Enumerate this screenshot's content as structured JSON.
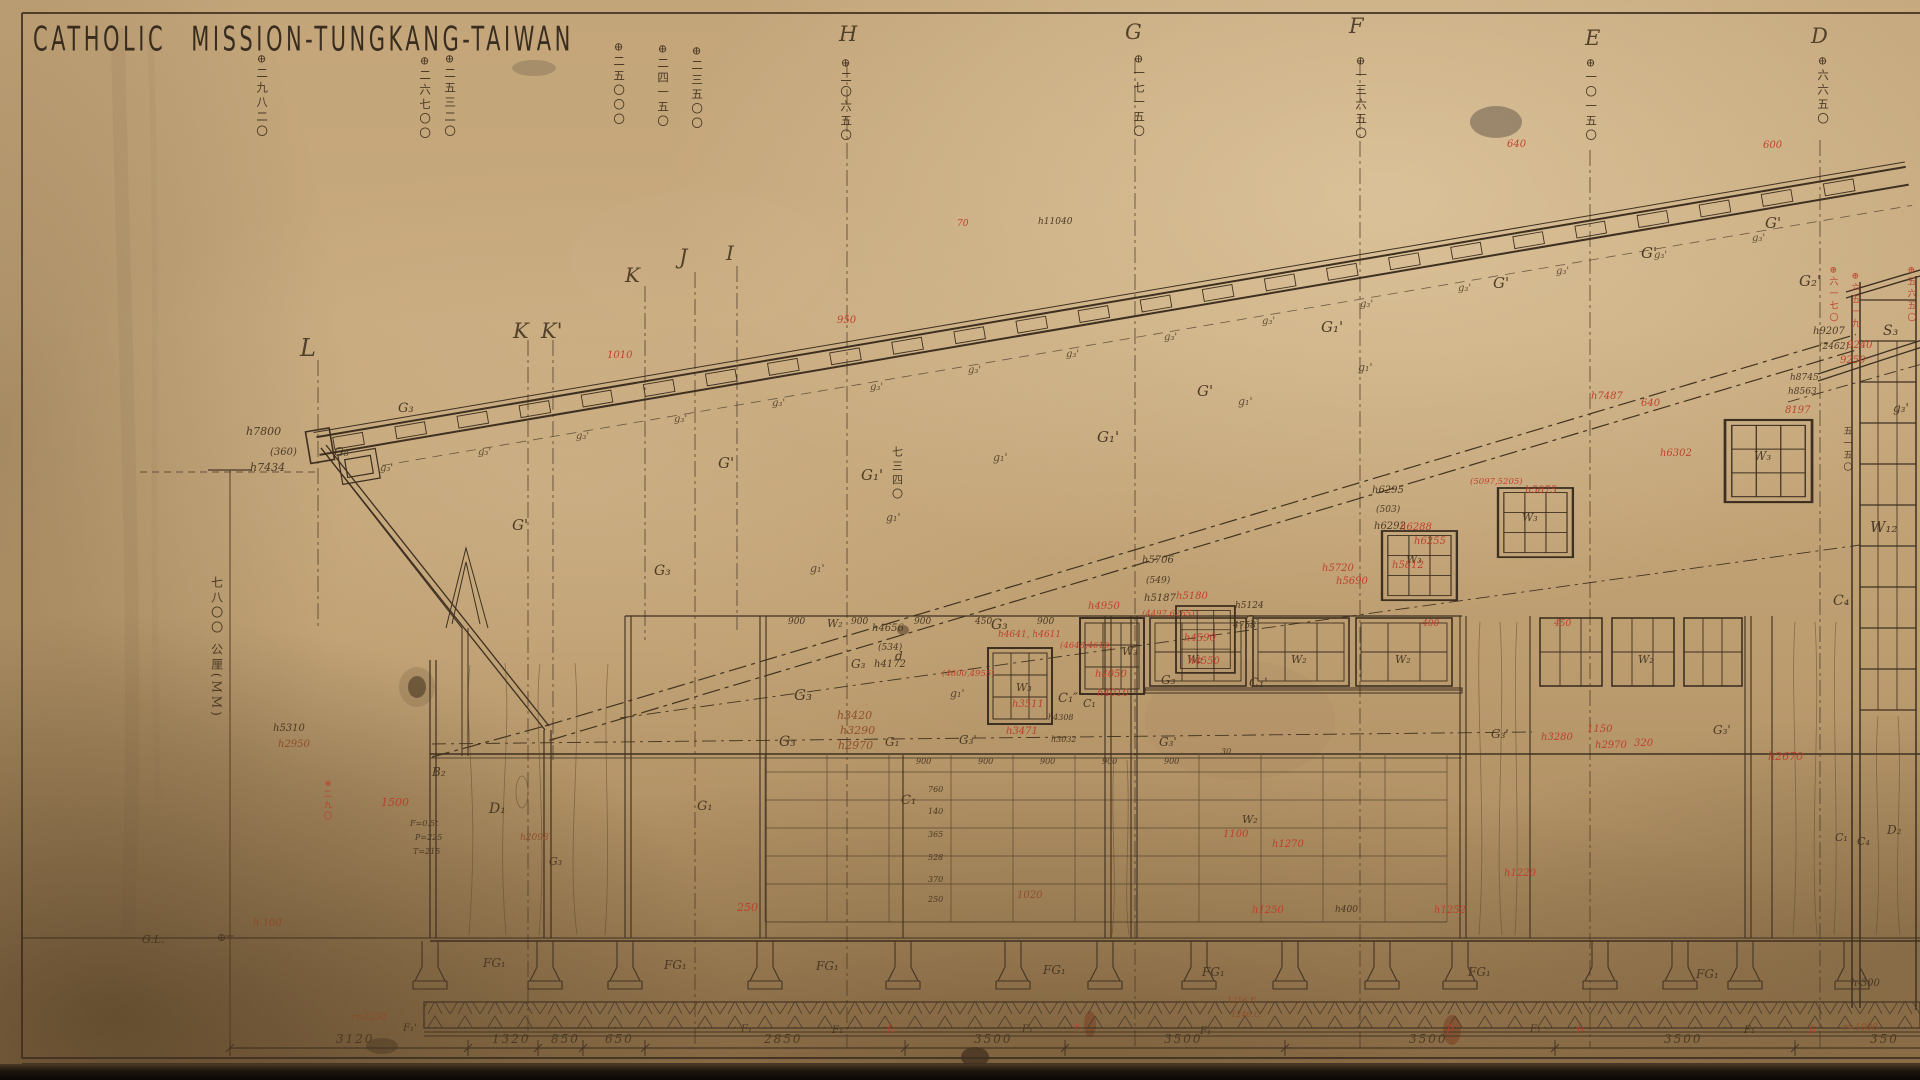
{
  "title": "CATHOLIC MISSION-TUNGKANG-TAIWAN",
  "colors": {
    "k": "#43331f",
    "r": "#bf3a28",
    "b": "#8d4a26"
  },
  "grid_letters": [
    {
      "t": "L",
      "x": 300,
      "y": 336,
      "s": 24
    },
    {
      "t": "K",
      "x": 513,
      "y": 321,
      "s": 21
    },
    {
      "t": "K'",
      "x": 541,
      "y": 321,
      "s": 21
    },
    {
      "t": "K",
      "x": 625,
      "y": 265,
      "s": 20
    },
    {
      "t": "J",
      "x": 679,
      "y": 247,
      "s": 21
    },
    {
      "t": "I",
      "x": 726,
      "y": 243,
      "s": 20
    },
    {
      "t": "H",
      "x": 839,
      "y": 24,
      "s": 21
    },
    {
      "t": "G",
      "x": 1125,
      "y": 22,
      "s": 21
    },
    {
      "t": "F",
      "x": 1349,
      "y": 16,
      "s": 21
    },
    {
      "t": "E",
      "x": 1585,
      "y": 28,
      "s": 21
    },
    {
      "t": "D",
      "x": 1811,
      "y": 26,
      "s": 21
    }
  ],
  "elevation_marks": [
    {
      "t": "⊕二九八二〇",
      "x": 256,
      "y": 54
    },
    {
      "t": "⊕二六七〇〇",
      "x": 419,
      "y": 56
    },
    {
      "t": "⊕二五三二〇",
      "x": 444,
      "y": 54
    },
    {
      "t": "⊕二五〇〇〇",
      "x": 613,
      "y": 42
    },
    {
      "t": "⊕二四一五〇",
      "x": 657,
      "y": 44
    },
    {
      "t": "⊕二三五〇〇",
      "x": 691,
      "y": 46
    },
    {
      "t": "⊕二〇六五〇",
      "x": 840,
      "y": 58
    },
    {
      "t": "⊕一七一五〇",
      "x": 1133,
      "y": 54
    },
    {
      "t": "⊕一三六五〇",
      "x": 1355,
      "y": 56
    },
    {
      "t": "⊕一〇一五〇",
      "x": 1585,
      "y": 58
    },
    {
      "t": "⊕六六五〇",
      "x": 1817,
      "y": 56
    }
  ],
  "left_scale": {
    "t": "七八〇〇 公厘(MM)",
    "x": 210,
    "y": 576,
    "s": 12
  },
  "bottom_dimensions": {
    "y": 1033,
    "values": [
      {
        "t": "3120",
        "x": 336
      },
      {
        "t": "1320",
        "x": 492
      },
      {
        "t": "850",
        "x": 551
      },
      {
        "t": "650",
        "x": 605
      },
      {
        "t": "2850",
        "x": 764
      },
      {
        "t": "3500",
        "x": 974
      },
      {
        "t": "3500",
        "x": 1164
      },
      {
        "t": "3500",
        "x": 1409
      },
      {
        "t": "3500",
        "x": 1664
      },
      {
        "t": "350",
        "x": 1870
      }
    ]
  },
  "g_marks": {
    "under_text": "g₃'",
    "mid_text": "g₁'",
    "under": [
      [
        380,
        464
      ],
      [
        478,
        448
      ],
      [
        576,
        432
      ],
      [
        674,
        415
      ],
      [
        772,
        399
      ],
      [
        870,
        383
      ],
      [
        968,
        366
      ],
      [
        1066,
        350
      ],
      [
        1164,
        333
      ],
      [
        1262,
        317
      ],
      [
        1360,
        300
      ],
      [
        1458,
        284
      ],
      [
        1556,
        267
      ],
      [
        1654,
        251
      ],
      [
        1752,
        234
      ]
    ],
    "mid": [
      [
        810,
        563
      ],
      [
        886,
        512
      ],
      [
        993,
        452
      ],
      [
        1238,
        396
      ],
      [
        1358,
        362
      ],
      [
        950,
        688
      ]
    ]
  },
  "annotations": [
    {
      "t": "h7800",
      "x": 246,
      "y": 426,
      "s": 11
    },
    {
      "t": "(360)",
      "x": 270,
      "y": 448,
      "s": 10
    },
    {
      "t": "h7434",
      "x": 250,
      "y": 462,
      "s": 11
    },
    {
      "t": "G₈",
      "x": 334,
      "y": 446,
      "s": 12
    },
    {
      "t": "G₃",
      "x": 398,
      "y": 402,
      "s": 13
    },
    {
      "t": "h11040",
      "x": 1038,
      "y": 218,
      "s": 9
    },
    {
      "t": "G'",
      "x": 512,
      "y": 518,
      "s": 15
    },
    {
      "t": "G'",
      "x": 718,
      "y": 456,
      "s": 15
    },
    {
      "t": "G₁'",
      "x": 861,
      "y": 468,
      "s": 15
    },
    {
      "t": "G₁'",
      "x": 1097,
      "y": 430,
      "s": 15
    },
    {
      "t": "G'",
      "x": 1197,
      "y": 384,
      "s": 15
    },
    {
      "t": "G₁'",
      "x": 1321,
      "y": 320,
      "s": 15
    },
    {
      "t": "G'",
      "x": 1493,
      "y": 276,
      "s": 15
    },
    {
      "t": "G'",
      "x": 1641,
      "y": 246,
      "s": 15
    },
    {
      "t": "G'",
      "x": 1765,
      "y": 216,
      "s": 15
    },
    {
      "t": "G₂'",
      "x": 1799,
      "y": 274,
      "s": 15
    },
    {
      "t": "S₃",
      "x": 1883,
      "y": 324,
      "s": 14
    },
    {
      "t": "g₃'",
      "x": 1893,
      "y": 402,
      "s": 12
    },
    {
      "t": "G₃",
      "x": 654,
      "y": 564,
      "s": 14
    },
    {
      "t": "G₃",
      "x": 851,
      "y": 658,
      "s": 12
    },
    {
      "t": "G₃",
      "x": 794,
      "y": 688,
      "s": 15
    },
    {
      "t": "G₃",
      "x": 779,
      "y": 735,
      "s": 14
    },
    {
      "t": "G₃",
      "x": 991,
      "y": 618,
      "s": 14
    },
    {
      "t": "G₃",
      "x": 1245,
      "y": 614,
      "s": 12
    },
    {
      "t": "G₃",
      "x": 1161,
      "y": 674,
      "s": 12
    },
    {
      "t": "G₃",
      "x": 549,
      "y": 856,
      "s": 11
    },
    {
      "t": "G₃'",
      "x": 959,
      "y": 734,
      "s": 12
    },
    {
      "t": "G₃'",
      "x": 1159,
      "y": 736,
      "s": 12
    },
    {
      "t": "G₃'",
      "x": 1491,
      "y": 728,
      "s": 12
    },
    {
      "t": "G₃'",
      "x": 1713,
      "y": 724,
      "s": 12
    },
    {
      "t": "G₁",
      "x": 885,
      "y": 736,
      "s": 12
    },
    {
      "t": "G₁",
      "x": 697,
      "y": 800,
      "s": 13
    },
    {
      "t": "C₁",
      "x": 901,
      "y": 794,
      "s": 13
    },
    {
      "t": "C₁″",
      "x": 1058,
      "y": 692,
      "s": 13
    },
    {
      "t": "C₁",
      "x": 1083,
      "y": 698,
      "s": 11
    },
    {
      "t": "C₁'",
      "x": 1249,
      "y": 677,
      "s": 13
    },
    {
      "t": "C₄",
      "x": 1833,
      "y": 594,
      "s": 14
    },
    {
      "t": "C₁",
      "x": 1835,
      "y": 832,
      "s": 11
    },
    {
      "t": "C₄",
      "x": 1857,
      "y": 836,
      "s": 11
    },
    {
      "t": "D₂",
      "x": 1887,
      "y": 824,
      "s": 12
    },
    {
      "t": "D₁",
      "x": 489,
      "y": 802,
      "s": 14
    },
    {
      "t": "B₂",
      "x": 432,
      "y": 766,
      "s": 12
    },
    {
      "t": "d",
      "x": 895,
      "y": 650,
      "s": 12
    },
    {
      "t": "W₂",
      "x": 827,
      "y": 618,
      "s": 11
    },
    {
      "t": "W₂",
      "x": 1187,
      "y": 654,
      "s": 11
    },
    {
      "t": "W₂",
      "x": 1291,
      "y": 654,
      "s": 11
    },
    {
      "t": "W₂",
      "x": 1395,
      "y": 654,
      "s": 11
    },
    {
      "t": "W₂",
      "x": 1638,
      "y": 654,
      "s": 11
    },
    {
      "t": "W₂",
      "x": 1242,
      "y": 814,
      "s": 11
    },
    {
      "t": "W₃",
      "x": 1016,
      "y": 682,
      "s": 11
    },
    {
      "t": "W₃",
      "x": 1122,
      "y": 646,
      "s": 11
    },
    {
      "t": "W₃",
      "x": 1406,
      "y": 554,
      "s": 11
    },
    {
      "t": "W₃",
      "x": 1522,
      "y": 512,
      "s": 11
    },
    {
      "t": "W₃",
      "x": 1754,
      "y": 450,
      "s": 12
    },
    {
      "t": "W₁₂",
      "x": 1870,
      "y": 520,
      "s": 15
    },
    {
      "t": "h4656",
      "x": 872,
      "y": 624,
      "s": 10
    },
    {
      "t": "(534)",
      "x": 878,
      "y": 644,
      "s": 9
    },
    {
      "t": "h4172",
      "x": 874,
      "y": 660,
      "s": 10
    },
    {
      "t": "h5706",
      "x": 1142,
      "y": 556,
      "s": 10
    },
    {
      "t": "(549)",
      "x": 1146,
      "y": 577,
      "s": 9
    },
    {
      "t": "h5187",
      "x": 1144,
      "y": 594,
      "s": 10
    },
    {
      "t": "h6295",
      "x": 1372,
      "y": 486,
      "s": 10
    },
    {
      "t": "(503)",
      "x": 1376,
      "y": 506,
      "s": 9
    },
    {
      "t": "h6292",
      "x": 1374,
      "y": 522,
      "s": 10
    },
    {
      "t": "h9207",
      "x": 1813,
      "y": 327,
      "s": 10
    },
    {
      "t": "(2462)",
      "x": 1819,
      "y": 343,
      "s": 9
    },
    {
      "t": "h8745",
      "x": 1790,
      "y": 374,
      "s": 9
    },
    {
      "t": "h8563",
      "x": 1788,
      "y": 388,
      "s": 9
    },
    {
      "t": "h5124",
      "x": 1235,
      "y": 602,
      "s": 9
    },
    {
      "t": "4758",
      "x": 1233,
      "y": 622,
      "s": 9
    },
    {
      "t": "h4308",
      "x": 1048,
      "y": 714,
      "s": 8
    },
    {
      "t": "h3032",
      "x": 1051,
      "y": 736,
      "s": 8
    },
    {
      "t": "h5310",
      "x": 273,
      "y": 724,
      "s": 10
    },
    {
      "t": "F=0.5t",
      "x": 410,
      "y": 820,
      "s": 8
    },
    {
      "t": "P=225",
      "x": 415,
      "y": 834,
      "s": 8
    },
    {
      "t": "T=215",
      "x": 413,
      "y": 848,
      "s": 8
    },
    {
      "t": "G.L.",
      "x": 142,
      "y": 934,
      "s": 11
    },
    {
      "t": "⊕",
      "x": 217,
      "y": 932,
      "s": 11
    },
    {
      "t": "h400",
      "x": 1335,
      "y": 906,
      "s": 9
    },
    {
      "t": "h-300",
      "x": 1851,
      "y": 979,
      "s": 10
    },
    {
      "t": "FG₁",
      "x": 483,
      "y": 957,
      "s": 12
    },
    {
      "t": "FG₁",
      "x": 664,
      "y": 959,
      "s": 12
    },
    {
      "t": "FG₁",
      "x": 816,
      "y": 960,
      "s": 12
    },
    {
      "t": "FG₁",
      "x": 1043,
      "y": 964,
      "s": 12
    },
    {
      "t": "FG₁",
      "x": 1202,
      "y": 966,
      "s": 12
    },
    {
      "t": "FG₁",
      "x": 1468,
      "y": 966,
      "s": 12
    },
    {
      "t": "FG₁",
      "x": 1696,
      "y": 968,
      "s": 12
    },
    {
      "t": "F₁'",
      "x": 403,
      "y": 1024,
      "s": 10
    },
    {
      "t": "F₁",
      "x": 741,
      "y": 1025,
      "s": 10
    },
    {
      "t": "F₁",
      "x": 832,
      "y": 1026,
      "s": 10
    },
    {
      "t": "F₁",
      "x": 1022,
      "y": 1025,
      "s": 10
    },
    {
      "t": "F₁",
      "x": 1200,
      "y": 1027,
      "s": 10
    },
    {
      "t": "F₁",
      "x": 1530,
      "y": 1025,
      "s": 10
    },
    {
      "t": "F₁",
      "x": 1744,
      "y": 1026,
      "s": 10
    },
    {
      "t": "30",
      "x": 1221,
      "y": 748,
      "s": 8
    },
    {
      "t": "900",
      "x": 788,
      "y": 618,
      "s": 9
    },
    {
      "t": "900",
      "x": 851,
      "y": 618,
      "s": 9
    },
    {
      "t": "900",
      "x": 914,
      "y": 618,
      "s": 9
    },
    {
      "t": "450",
      "x": 975,
      "y": 618,
      "s": 9
    },
    {
      "t": "900",
      "x": 1037,
      "y": 618,
      "s": 9
    },
    {
      "t": "900",
      "x": 916,
      "y": 758,
      "s": 8
    },
    {
      "t": "900",
      "x": 978,
      "y": 758,
      "s": 8
    },
    {
      "t": "900",
      "x": 1040,
      "y": 758,
      "s": 8
    },
    {
      "t": "900",
      "x": 1102,
      "y": 758,
      "s": 8
    },
    {
      "t": "900",
      "x": 1164,
      "y": 758,
      "s": 8
    },
    {
      "t": "760",
      "x": 928,
      "y": 786,
      "s": 8
    },
    {
      "t": "140",
      "x": 928,
      "y": 808,
      "s": 8
    },
    {
      "t": "365",
      "x": 928,
      "y": 831,
      "s": 8
    },
    {
      "t": "528",
      "x": 928,
      "y": 854,
      "s": 8
    },
    {
      "t": "370",
      "x": 928,
      "y": 876,
      "s": 8
    },
    {
      "t": "250",
      "x": 928,
      "y": 896,
      "s": 8
    },
    {
      "t": "七三四〇",
      "x": 891,
      "y": 446,
      "s": 11,
      "v": 1
    },
    {
      "t": "五一五〇",
      "x": 1841,
      "y": 426,
      "s": 9,
      "v": 1
    },
    {
      "t": "600",
      "x": 1763,
      "y": 141,
      "c": "r",
      "s": 10
    },
    {
      "t": "640",
      "x": 1507,
      "y": 140,
      "c": "r",
      "s": 10
    },
    {
      "t": "70",
      "x": 957,
      "y": 220,
      "c": "r",
      "s": 9
    },
    {
      "t": "950",
      "x": 837,
      "y": 316,
      "c": "r",
      "s": 10
    },
    {
      "t": "1010",
      "x": 607,
      "y": 351,
      "c": "r",
      "s": 10
    },
    {
      "t": "9240",
      "x": 1847,
      "y": 341,
      "c": "r",
      "s": 10
    },
    {
      "t": "9250",
      "x": 1840,
      "y": 356,
      "c": "r",
      "s": 10
    },
    {
      "t": "8197",
      "x": 1785,
      "y": 406,
      "c": "r",
      "s": 10
    },
    {
      "t": "h4641, h4611",
      "x": 998,
      "y": 631,
      "c": "r",
      "s": 9
    },
    {
      "t": "(4600,4955)",
      "x": 942,
      "y": 670,
      "c": "r",
      "s": 8.5
    },
    {
      "t": "h3511",
      "x": 1012,
      "y": 700,
      "c": "r",
      "s": 10
    },
    {
      "t": "h3471",
      "x": 1006,
      "y": 727,
      "c": "r",
      "s": 10
    },
    {
      "t": "h4950",
      "x": 1088,
      "y": 602,
      "c": "r",
      "s": 10
    },
    {
      "t": "(4648,4610)",
      "x": 1060,
      "y": 642,
      "c": "r",
      "s": 8.5
    },
    {
      "t": "h4050",
      "x": 1095,
      "y": 670,
      "c": "r",
      "s": 10
    },
    {
      "t": "h4010",
      "x": 1097,
      "y": 689,
      "c": "r",
      "s": 10
    },
    {
      "t": "(4497,6265)",
      "x": 1142,
      "y": 610,
      "c": "r",
      "s": 8.5
    },
    {
      "t": "h4590",
      "x": 1184,
      "y": 634,
      "c": "r",
      "s": 10
    },
    {
      "t": "h4550",
      "x": 1188,
      "y": 657,
      "c": "r",
      "s": 10
    },
    {
      "t": "h5720",
      "x": 1322,
      "y": 564,
      "c": "r",
      "s": 10
    },
    {
      "t": "h5690",
      "x": 1336,
      "y": 577,
      "c": "r",
      "s": 10
    },
    {
      "t": "h5180",
      "x": 1176,
      "y": 592,
      "c": "r",
      "s": 10
    },
    {
      "t": "h6288",
      "x": 1400,
      "y": 523,
      "c": "r",
      "s": 10
    },
    {
      "t": "h6255",
      "x": 1414,
      "y": 537,
      "c": "r",
      "s": 10
    },
    {
      "t": "h5812",
      "x": 1392,
      "y": 561,
      "c": "r",
      "s": 10
    },
    {
      "t": "h5875",
      "x": 1525,
      "y": 486,
      "c": "r",
      "s": 10
    },
    {
      "t": "(5097,5205)",
      "x": 1470,
      "y": 478,
      "c": "r",
      "s": 8.5
    },
    {
      "t": "h7487",
      "x": 1591,
      "y": 392,
      "c": "r",
      "s": 10
    },
    {
      "t": "640",
      "x": 1641,
      "y": 399,
      "c": "r",
      "s": 10
    },
    {
      "t": "h6302",
      "x": 1660,
      "y": 449,
      "c": "r",
      "s": 10
    },
    {
      "t": "h2670",
      "x": 1768,
      "y": 751,
      "c": "r",
      "s": 11
    },
    {
      "t": "1150",
      "x": 1587,
      "y": 725,
      "c": "r",
      "s": 10
    },
    {
      "t": "320",
      "x": 1634,
      "y": 739,
      "c": "r",
      "s": 10
    },
    {
      "t": "h2970",
      "x": 1595,
      "y": 741,
      "c": "r",
      "s": 10
    },
    {
      "t": "h3280",
      "x": 1541,
      "y": 733,
      "c": "r",
      "s": 10
    },
    {
      "t": "400",
      "x": 1422,
      "y": 620,
      "c": "r",
      "s": 9
    },
    {
      "t": "450",
      "x": 1554,
      "y": 620,
      "c": "r",
      "s": 9
    },
    {
      "t": "1100",
      "x": 1223,
      "y": 830,
      "c": "r",
      "s": 10
    },
    {
      "t": "h1270",
      "x": 1272,
      "y": 840,
      "c": "r",
      "s": 10
    },
    {
      "t": "250",
      "x": 737,
      "y": 902,
      "c": "r",
      "s": 11
    },
    {
      "t": "h1250",
      "x": 1252,
      "y": 906,
      "c": "r",
      "s": 10
    },
    {
      "t": "h1252",
      "x": 1434,
      "y": 906,
      "c": "r",
      "s": 10
    },
    {
      "t": "h1220",
      "x": 1504,
      "y": 869,
      "c": "r",
      "s": 10
    },
    {
      "t": "1500",
      "x": 381,
      "y": 797,
      "c": "r",
      "s": 11
    },
    {
      "t": "f₁",
      "x": 887,
      "y": 1025,
      "c": "r",
      "s": 10
    },
    {
      "t": "f₁",
      "x": 1074,
      "y": 1025,
      "c": "r",
      "s": 10
    },
    {
      "t": "f₁",
      "x": 1447,
      "y": 1024,
      "c": "r",
      "s": 10
    },
    {
      "t": "f₁",
      "x": 1577,
      "y": 1024,
      "c": "r",
      "s": 10
    },
    {
      "t": "f₁",
      "x": 1809,
      "y": 1025,
      "c": "r",
      "s": 10
    },
    {
      "t": "⊕二九〇",
      "x": 323,
      "y": 780,
      "c": "r",
      "s": 8,
      "v": 1
    },
    {
      "t": "⊕六一七〇",
      "x": 1827,
      "y": 266,
      "c": "r",
      "s": 9,
      "v": 1
    },
    {
      "t": "⊕六五一九",
      "x": 1849,
      "y": 272,
      "c": "r",
      "s": 9,
      "v": 1
    },
    {
      "t": "⊕五六五〇",
      "x": 1905,
      "y": 266,
      "c": "r",
      "s": 9,
      "v": 1
    },
    {
      "t": "h2950",
      "x": 278,
      "y": 740,
      "c": "b",
      "s": 10
    },
    {
      "t": "h3420",
      "x": 837,
      "y": 710,
      "c": "b",
      "s": 11
    },
    {
      "t": "h3290",
      "x": 840,
      "y": 725,
      "c": "b",
      "s": 11
    },
    {
      "t": "h2970",
      "x": 838,
      "y": 740,
      "c": "b",
      "s": 11
    },
    {
      "t": "1020",
      "x": 1017,
      "y": 891,
      "c": "b",
      "s": 10
    },
    {
      "t": "h2098",
      "x": 520,
      "y": 834,
      "c": "b",
      "s": 9
    },
    {
      "t": "r=2250",
      "x": 351,
      "y": 1014,
      "c": "b",
      "s": 9
    },
    {
      "t": "r=1000",
      "x": 1843,
      "y": 1024,
      "c": "b",
      "s": 9
    },
    {
      "t": "h 100",
      "x": 253,
      "y": 919,
      "c": "b",
      "s": 10
    },
    {
      "t": "1216.F.",
      "x": 1227,
      "y": 997,
      "c": "b",
      "s": 8
    },
    {
      "t": "1246.C.",
      "x": 1231,
      "y": 1011,
      "c": "b",
      "s": 8
    }
  ]
}
